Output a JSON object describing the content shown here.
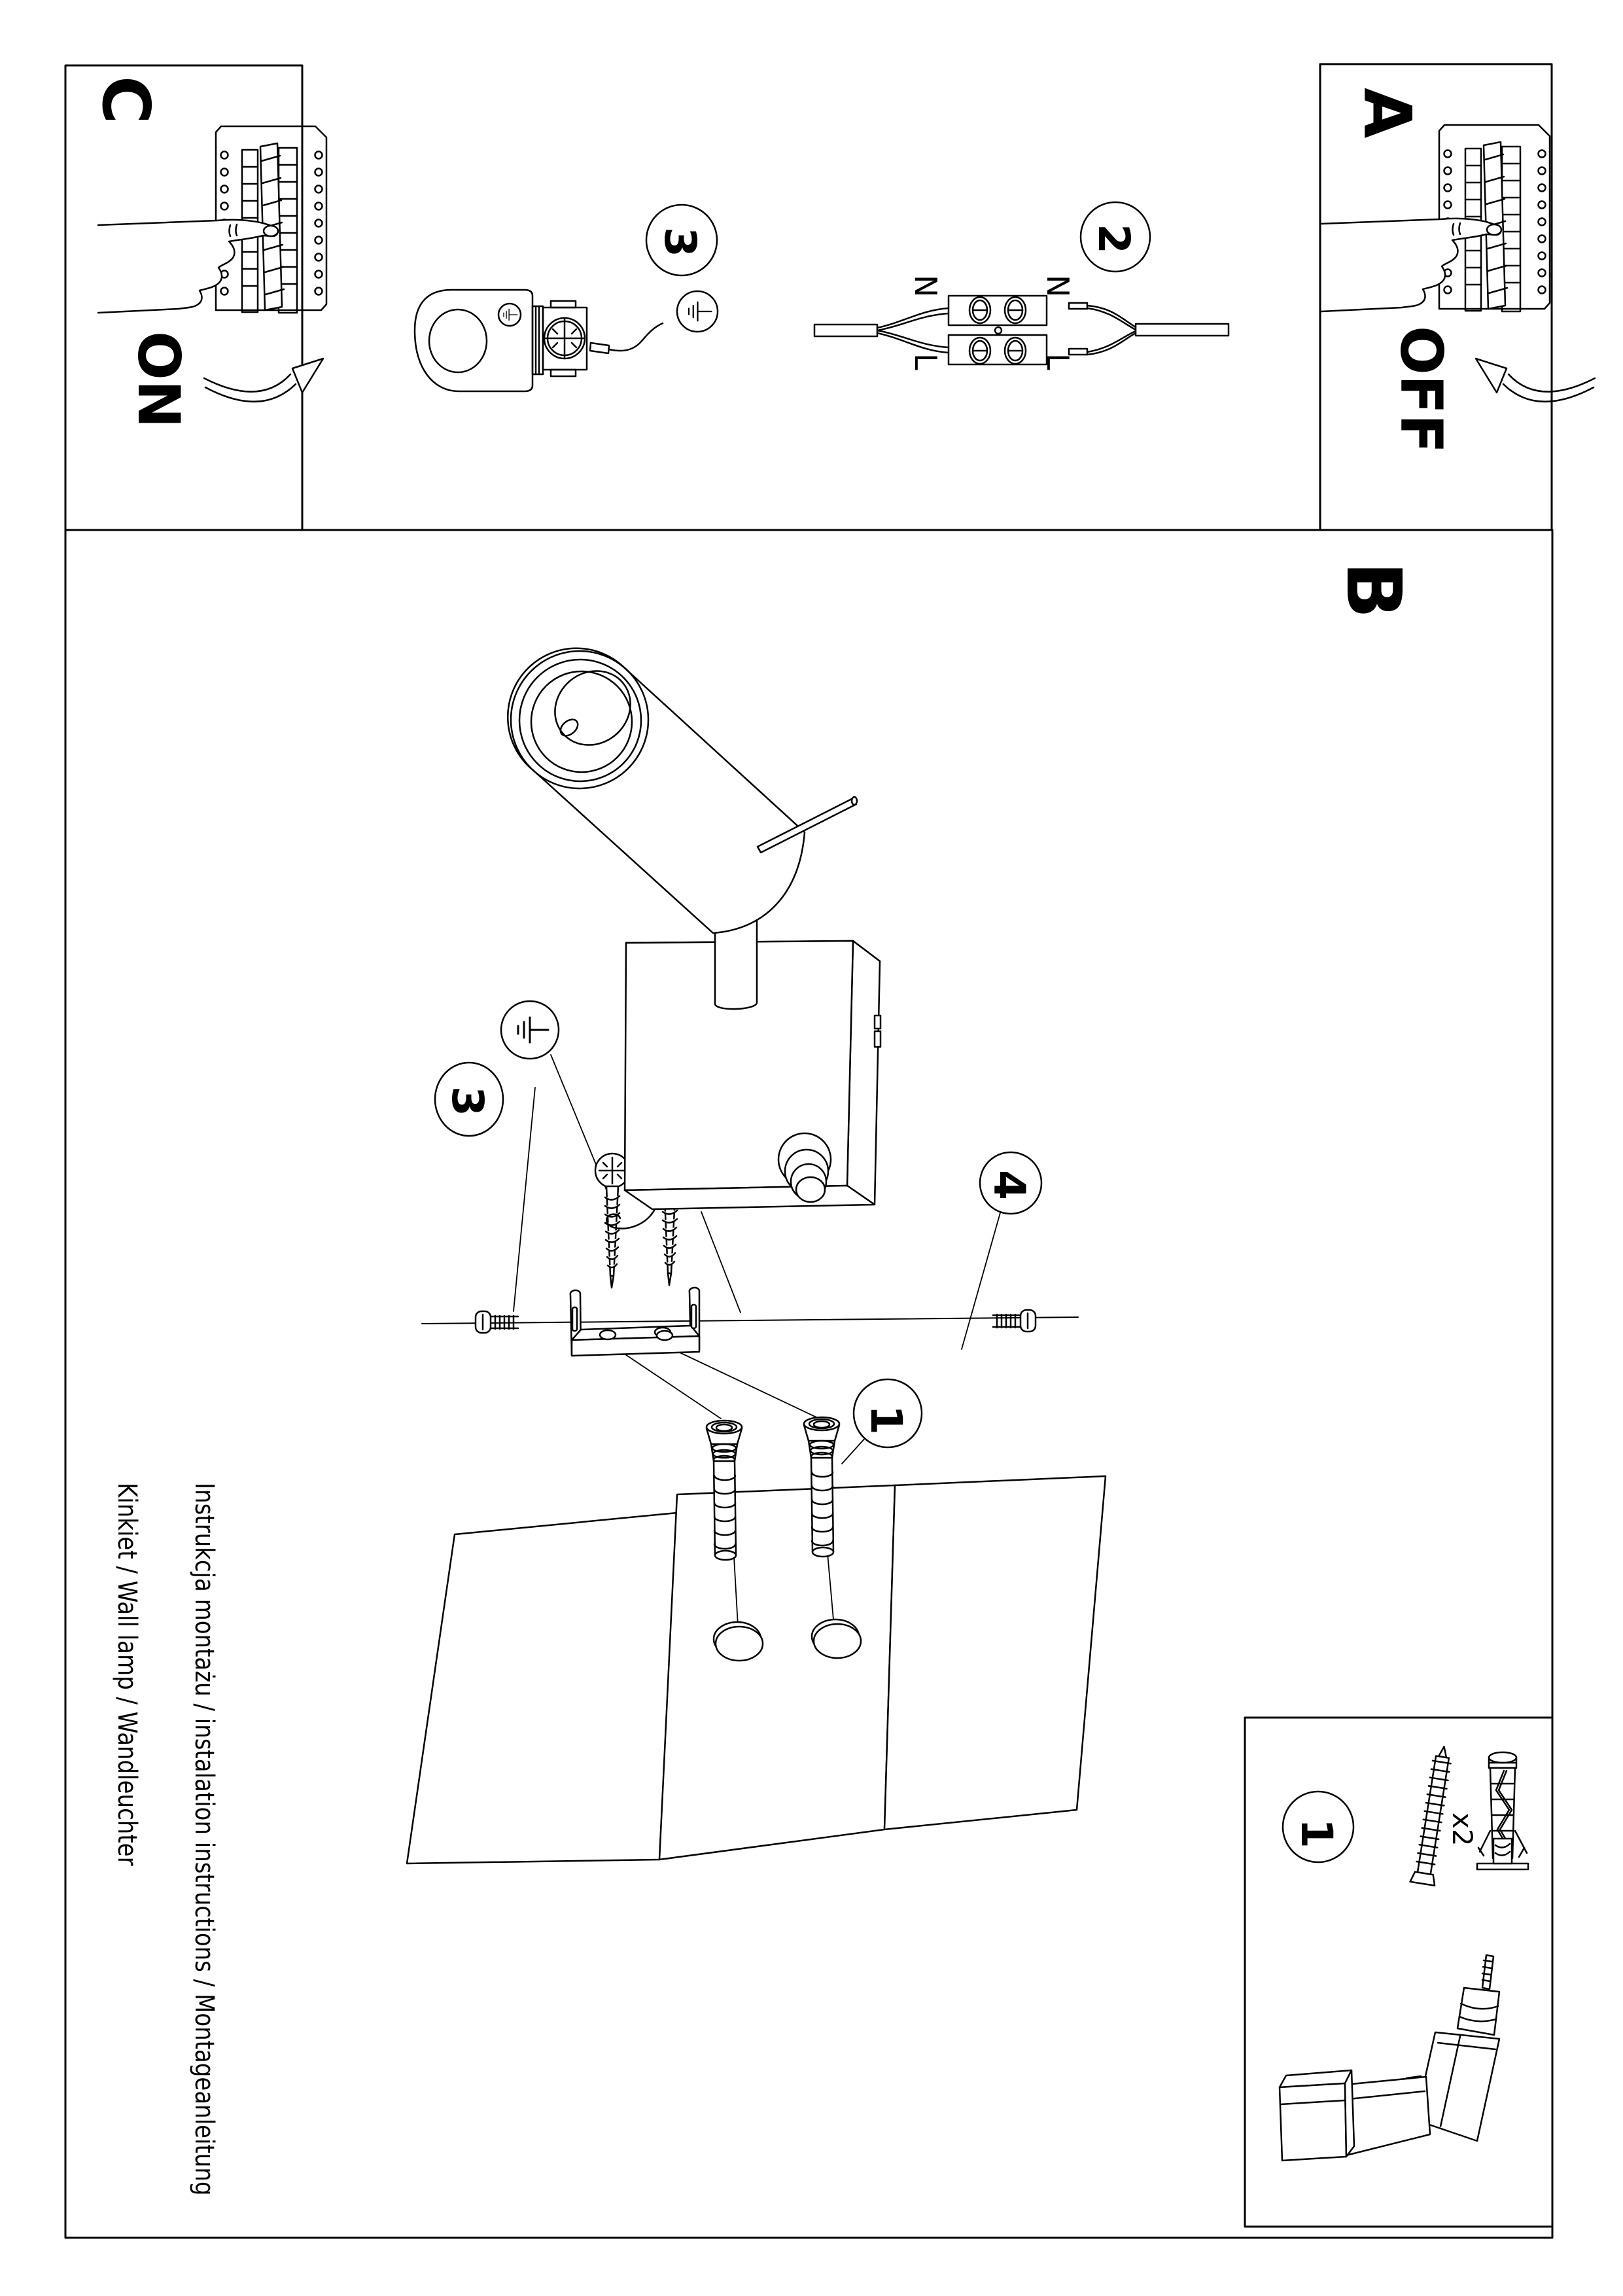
{
  "steps": {
    "a": {
      "label": "A",
      "power": "OFF"
    },
    "b": {
      "label": "B"
    },
    "c": {
      "label": "C",
      "power": "ON"
    }
  },
  "callouts": {
    "wire_prep": "3",
    "terminal": "2",
    "ground": "3",
    "bracket": "4",
    "anchors": "1",
    "parts": "1"
  },
  "wiring": {
    "n_left": "N",
    "l_left": "L",
    "n_right": "N",
    "l_right": "L"
  },
  "parts_box": {
    "quantity": "x2"
  },
  "footer": {
    "line1": "Instrukcja montażu / instalation instructions / Montageanleitung",
    "line2": "Kinkiet / Wall lamp / Wandleuchter"
  },
  "colors": {
    "ink": "#000000",
    "paper": "#ffffff"
  }
}
